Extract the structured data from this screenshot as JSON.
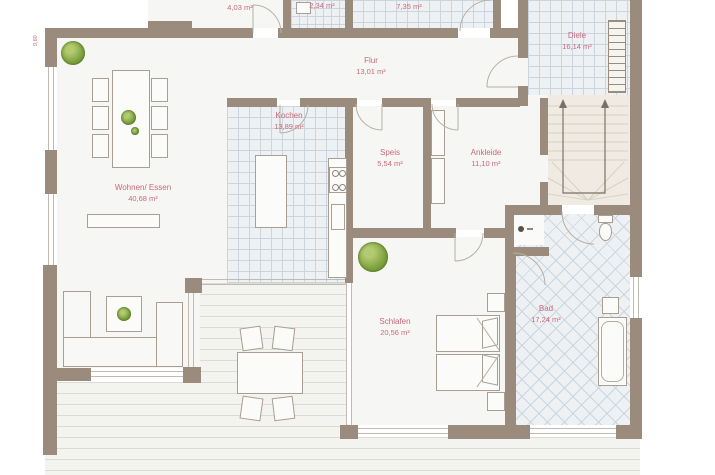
{
  "plan": {
    "title": "Grundriss Erdgeschoss",
    "dimension_label": "9,60",
    "rooms": [
      {
        "id": "room-a",
        "name": "",
        "area": "4,03 m²"
      },
      {
        "id": "wc",
        "name": "WC",
        "area": "2,34 m²"
      },
      {
        "id": "room-b",
        "name": "",
        "area": "7,35 m²"
      },
      {
        "id": "diele",
        "name": "Diele",
        "area": "16,14 m²"
      },
      {
        "id": "flur",
        "name": "Flur",
        "area": "13,01 m²"
      },
      {
        "id": "wohnen-essen",
        "name": "Wohnen/ Essen",
        "area": "40,68 m²"
      },
      {
        "id": "kochen",
        "name": "Kochen",
        "area": "13,89 m²"
      },
      {
        "id": "speis",
        "name": "Speis",
        "area": "5,54 m²"
      },
      {
        "id": "ankleide",
        "name": "Ankleide",
        "area": "11,10 m²"
      },
      {
        "id": "schlafen",
        "name": "Schlafen",
        "area": "20,56 m²"
      },
      {
        "id": "bad",
        "name": "Bad",
        "area": "17,24 m²"
      }
    ],
    "colors": {
      "wall": "#9a8b7c",
      "room_label": "#c8687a",
      "tile_line": "#ccd5de",
      "deck_line": "#dcdbd3",
      "plant": "#84a644"
    }
  }
}
